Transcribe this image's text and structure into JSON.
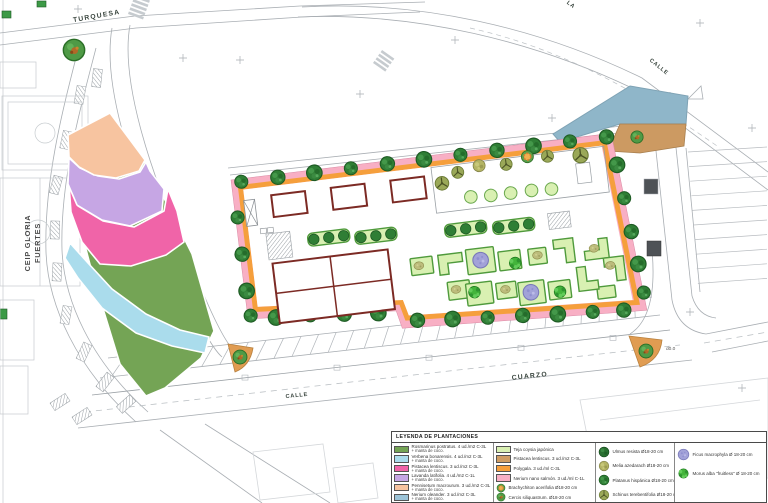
{
  "streets": {
    "turquesa": "TURQUESA",
    "la": "LA",
    "calle_right": "CALLE",
    "calle_bottom": "CALLE",
    "cuarzo": "CUARZO"
  },
  "labels": {
    "school_line1": "CEIP GLORIA",
    "school_line2": "FUERTES",
    "drain": "d0.0"
  },
  "legend": {
    "title": "LEYENDA DE PLANTACIONES",
    "columns": [
      {
        "rows": [
          {
            "icon": "swatch",
            "color": "#74a455",
            "label": "Rosmarinus postratus. 4 ud./m2 C-3L",
            "label2": "+ manta de coco."
          },
          {
            "icon": "swatch",
            "color": "#aadcec",
            "label": "Verbena bonarensis. 4 ud./m2 C-3L",
            "label2": "+ manta de coco."
          },
          {
            "icon": "swatch",
            "color": "#f064a8",
            "label": "Pistacea lentiscus. 3 ud./m2 C-3L",
            "label2": "+ manta de coco."
          },
          {
            "icon": "swatch",
            "color": "#c6a6e4",
            "label": "Lavanda latifolia. 4 ud./m2 C-1L",
            "label2": "+ manta de coco."
          },
          {
            "icon": "swatch",
            "color": "#f7c4a0",
            "label": "Pennisetum macrourum. 3 ud./m2 C-3L",
            "label2": "+ manta de coco."
          },
          {
            "icon": "swatch",
            "color": "#9cc4d8",
            "label": "Nerium oleander. 3 ud./m2 C-3L",
            "label2": "+ manta de coco."
          }
        ]
      },
      {
        "rows": [
          {
            "icon": "swatch",
            "color": "#d9f0b2",
            "label": "Teja coysia japónica"
          },
          {
            "icon": "swatch",
            "color": "#cf9d64",
            "label": "Pistacea lentiscus. 3 ud./m2 C-3L"
          },
          {
            "icon": "swatch",
            "color": "#f59f3c",
            "label": "Polygala. 3 ud./ml C-3L"
          },
          {
            "icon": "swatch",
            "color": "#f8afc4",
            "label": "Nerium nano salmón. 3 ud./ml C-1L"
          },
          {
            "icon": "brachychiton",
            "label": "Brachychiton acerifolia Ø18-20 cm"
          },
          {
            "icon": "cercis",
            "label": "Cercis siliquastrum. Ø18-20 cm"
          }
        ]
      },
      {
        "rows": [
          {
            "icon": "ulmus",
            "label": "Ulmus resista Ø18-20 cm"
          },
          {
            "icon": "melia",
            "label": "Melia azedarach Ø18-20 cm"
          },
          {
            "icon": "platanus",
            "label": "Platanus hispánica Ø18-20 cm"
          },
          {
            "icon": "schinus",
            "label": "Schinus terebentifolia Ø18-20 cm"
          }
        ]
      },
      {
        "rows": [
          {
            "icon": "ficus",
            "label": "Ficus macrophyla Ø 18-20 cm"
          },
          {
            "icon": "morus",
            "label": "Morus alba \"fruitless\" Ø 18-20 cm"
          }
        ]
      }
    ]
  },
  "colors": {
    "rosmarinus_green": "#74a455",
    "verbena_blue": "#aadcec",
    "pistacea_magenta": "#f064a8",
    "lavanda_purple": "#c6a6e4",
    "pennisetum_salmon": "#f7c4a0",
    "nerium_blue": "#9cc4d8",
    "teja_lightgreen": "#d9f0b2",
    "pistacea_tan": "#cf9d64",
    "polygala_orange": "#f59f3c",
    "nerium_pink": "#f8afc4",
    "planter_green": "#4f9a3c",
    "maroon": "#7c2a24",
    "building_blue": "#8fb6c9",
    "building_tan": "#cc9a62",
    "corner_orange": "#e09c52",
    "tree_dark": "#2f7e35",
    "morus_green": "#43b43b",
    "ficus_purple": "#a2a2d8"
  }
}
